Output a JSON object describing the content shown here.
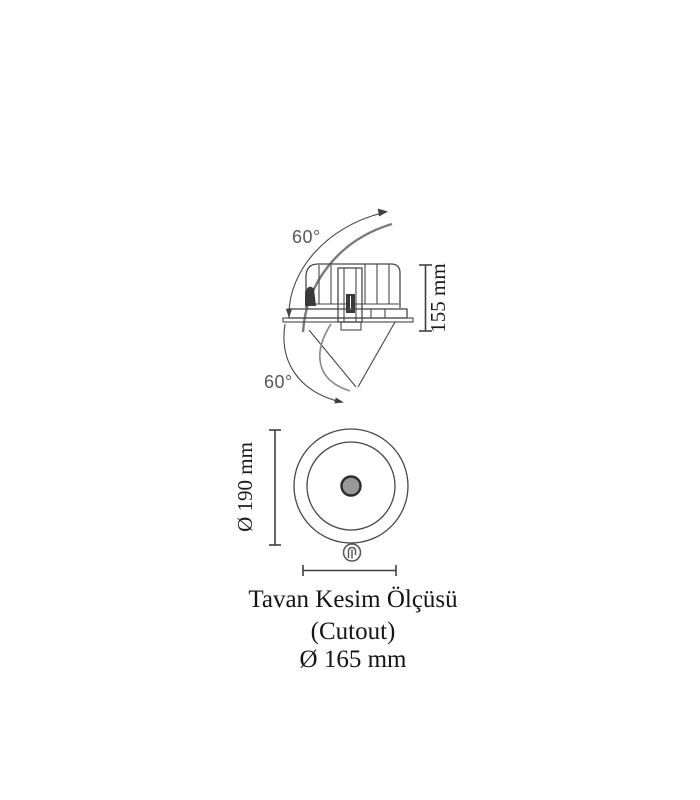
{
  "diagram": {
    "side_view": {
      "tilt_angle_top": "60°",
      "tilt_angle_bottom": "60°",
      "height_dimension": "155 mm"
    },
    "front_view": {
      "flange_diameter_dimension": "Ø 190 mm"
    },
    "caption": {
      "title": "Tavan Kesim Ölçüsü",
      "subtitle": "(Cutout)",
      "cutout_diameter": "Ø 165 mm"
    },
    "icons": [
      "rotation-arc-up-icon",
      "rotation-arc-down-icon",
      "mounting-clip-icon"
    ],
    "colors": {
      "background": "#ffffff",
      "line": "#474747",
      "soft_line": "#7b7b7b",
      "text": "#1b1b1b",
      "angle_text": "#585858",
      "lamp_dot_fill": "#989898"
    }
  }
}
